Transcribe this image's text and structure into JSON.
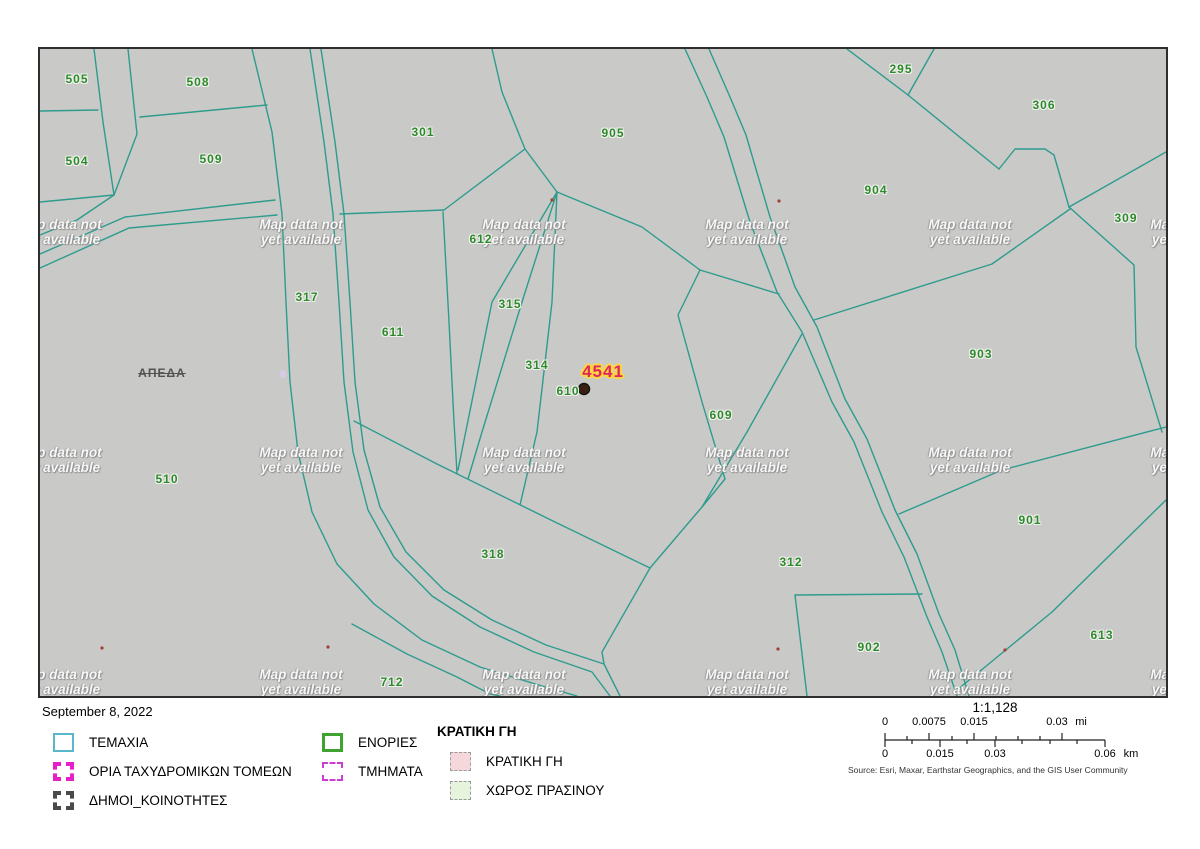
{
  "date": "September 8, 2022",
  "map": {
    "background_color": "#c9cac7",
    "line_color": "#2e9b8e",
    "parcel_label_color": "#2c8a2c",
    "watermark": {
      "line1": "Map data not",
      "line2": "yet available"
    },
    "area_label": {
      "text": "ΑΠΕΔΑ",
      "x": 122,
      "y": 324
    },
    "highlight": {
      "text": "4541",
      "x": 563,
      "y": 323,
      "color": "#e02560",
      "halo": "#ffd83d"
    },
    "marker": {
      "x": 544,
      "y": 340,
      "color": "#3a2013"
    },
    "parcels": [
      {
        "id": "505",
        "x": 37,
        "y": 30
      },
      {
        "id": "508",
        "x": 158,
        "y": 33
      },
      {
        "id": "504",
        "x": 37,
        "y": 112
      },
      {
        "id": "509",
        "x": 171,
        "y": 110
      },
      {
        "id": "301",
        "x": 383,
        "y": 83
      },
      {
        "id": "905",
        "x": 573,
        "y": 84
      },
      {
        "id": "295",
        "x": 861,
        "y": 20
      },
      {
        "id": "306",
        "x": 1004,
        "y": 56
      },
      {
        "id": "904",
        "x": 836,
        "y": 141
      },
      {
        "id": "309",
        "x": 1086,
        "y": 169
      },
      {
        "id": "317",
        "x": 267,
        "y": 248
      },
      {
        "id": "612",
        "x": 441,
        "y": 190
      },
      {
        "id": "315",
        "x": 470,
        "y": 255
      },
      {
        "id": "611",
        "x": 353,
        "y": 283
      },
      {
        "id": "314",
        "x": 497,
        "y": 316
      },
      {
        "id": "610",
        "x": 528,
        "y": 342
      },
      {
        "id": "609",
        "x": 681,
        "y": 366
      },
      {
        "id": "903",
        "x": 941,
        "y": 305
      },
      {
        "id": "510",
        "x": 127,
        "y": 430
      },
      {
        "id": "318",
        "x": 453,
        "y": 505
      },
      {
        "id": "312",
        "x": 751,
        "y": 513
      },
      {
        "id": "901",
        "x": 990,
        "y": 471
      },
      {
        "id": "902",
        "x": 829,
        "y": 598
      },
      {
        "id": "613",
        "x": 1062,
        "y": 586
      },
      {
        "id": "712",
        "x": 352,
        "y": 633
      }
    ]
  },
  "legend": {
    "groups": [
      {
        "header": "",
        "items": [
          {
            "label": "ΤΕΜΑΧΙΑ",
            "swatch": "temaxia"
          },
          {
            "label": "ΟΡΙΑ ΤΑΧΥΔΡΟΜΙΚΩΝ ΤΟΜΕΩΝ",
            "swatch": "oria"
          },
          {
            "label": "ΔΗΜΟΙ_ΚΟΙΝΟΤΗΤΕΣ",
            "swatch": "dimoi"
          }
        ]
      },
      {
        "header": "",
        "items": [
          {
            "label": "ΕΝΟΡΙΕΣ",
            "swatch": "enories"
          },
          {
            "label": "ΤΜΗΜΑΤΑ",
            "swatch": "tmimata"
          }
        ]
      },
      {
        "header": "ΚΡΑΤΙΚΗ ΓΗ",
        "items": [
          {
            "label": "ΚΡΑΤΙΚΗ ΓΗ",
            "swatch": "kratiki"
          },
          {
            "label": "ΧΩΡΟΣ ΠΡΑΣΙΝΟΥ",
            "swatch": "xoros"
          }
        ]
      }
    ]
  },
  "scalebar": {
    "ratio": "1:1,128",
    "mi": {
      "labels": [
        {
          "t": "0",
          "x": 885
        },
        {
          "t": "0.0075",
          "x": 929
        },
        {
          "t": "0.015",
          "x": 974
        },
        {
          "t": "0.03",
          "x": 1057
        }
      ],
      "unit": "mi",
      "unit_x": 1081
    },
    "km": {
      "labels": [
        {
          "t": "0",
          "x": 885
        },
        {
          "t": "0.015",
          "x": 940
        },
        {
          "t": "0.03",
          "x": 995
        },
        {
          "t": "0.06",
          "x": 1105
        }
      ],
      "unit": "km",
      "unit_x": 1131
    }
  },
  "source": "Source: Esri, Maxar, Earthstar Geographics, and the GIS User Community"
}
